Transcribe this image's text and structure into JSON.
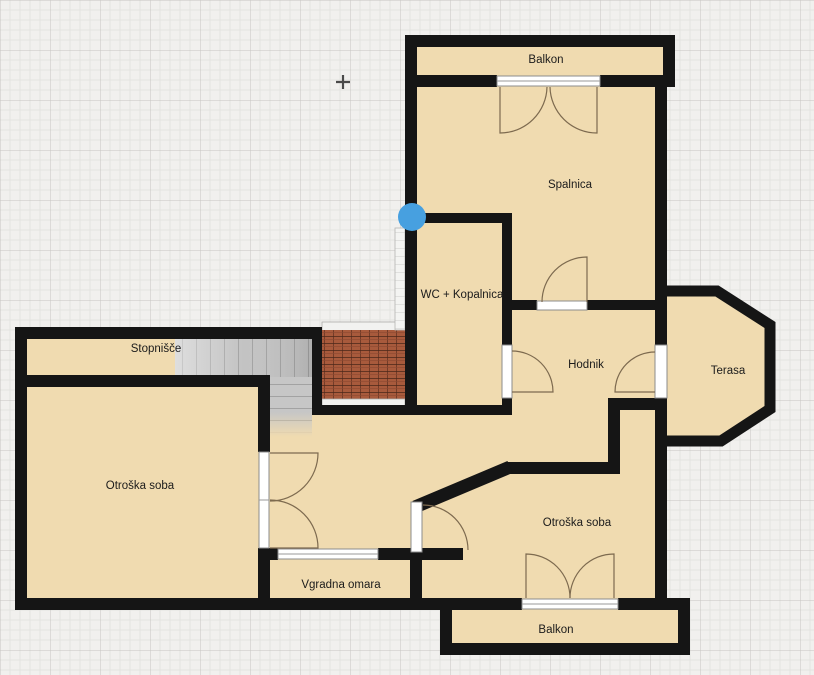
{
  "plan": {
    "rooms": [
      {
        "label": "Balkon"
      },
      {
        "label": "Spalnica"
      },
      {
        "label": "WC + Kopalnica"
      },
      {
        "label": "Stopnišče"
      },
      {
        "label": "Hodnik"
      },
      {
        "label": "Terasa"
      },
      {
        "label": "Otroška soba"
      },
      {
        "label": "Otroška soba"
      },
      {
        "label": "Vgradna omara"
      },
      {
        "label": "Balkon"
      }
    ],
    "markers": {
      "selection_handle_color": "#47a0e0",
      "crosshair_cursor": "+"
    },
    "colors": {
      "floor": "#f0dbb0",
      "wall": "#151515",
      "brick": "#a85a3c",
      "stairs": "#c3c3c3",
      "grid_major": "#c6c5c2",
      "grid_minor": "#e4e3e0",
      "background": "#f1f0ee"
    }
  }
}
